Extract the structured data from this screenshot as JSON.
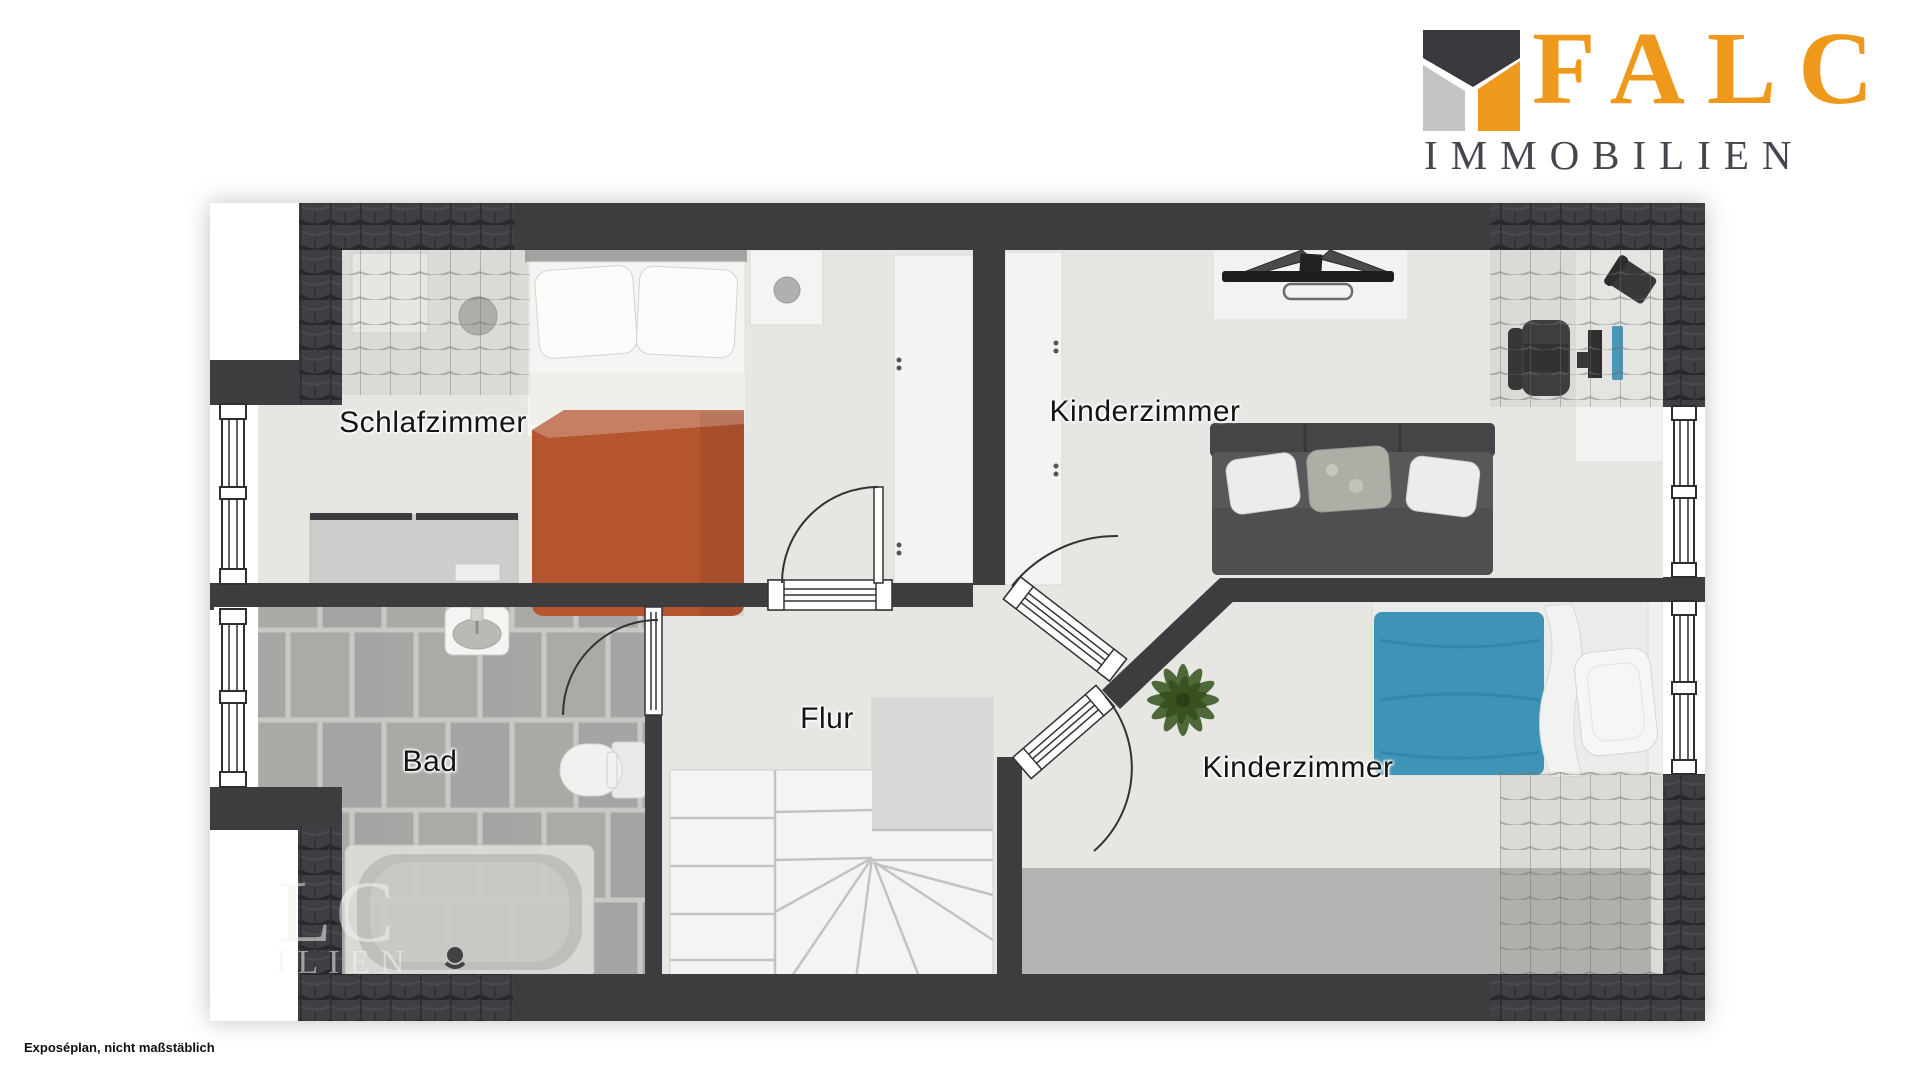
{
  "logo": {
    "brand": "FALC",
    "subtitle": "IMMOBILIEN",
    "mark_colors": {
      "dark": "#3a3a3e",
      "gray": "#c4c4c6",
      "orange": "#ef991c"
    }
  },
  "floorplan": {
    "title": "Obergeschoss Grundriss (Exposéplan)",
    "rooms": {
      "schlafzimmer": {
        "label": "Schlafzimmer"
      },
      "kinderzimmer_top": {
        "label": "Kinderzimmer"
      },
      "bad": {
        "label": "Bad"
      },
      "flur": {
        "label": "Flur"
      },
      "kinderzimmer_bottom": {
        "label": "Kinderzimmer"
      }
    },
    "furniture_icons": [
      "double-bed-icon",
      "nightstand-icon",
      "pouf-icon",
      "dresser-icon",
      "wardrobe-icon",
      "desk-monitor-icon",
      "office-chair-icon",
      "desk-phone-icon",
      "sofa-bed-icon",
      "single-bed-icon",
      "carpet-icon",
      "plant-icon",
      "sink-icon",
      "toilet-icon",
      "bathtub-icon",
      "stairs-icon",
      "door-icon",
      "window-icon"
    ],
    "watermark": {
      "fragment_large": "LC",
      "fragment_small": "ILIEN"
    }
  },
  "footer": {
    "disclaimer": "Exposéplan, nicht maßstäblich"
  },
  "colors": {
    "wall": "#3d3d40",
    "floor": "#e6e6e3",
    "bath_tile": "#a7a7a5",
    "bath_grout": "#c8c8c4",
    "blanket_orange": "#b4552f",
    "blanket_blue": "#3e94b6",
    "sofa_dark": "#4f4f52",
    "carpet": "#b4b4b2",
    "plant_green": "#466231",
    "brand_orange": "#ef991c",
    "logo_text_gray": "#45454d"
  }
}
